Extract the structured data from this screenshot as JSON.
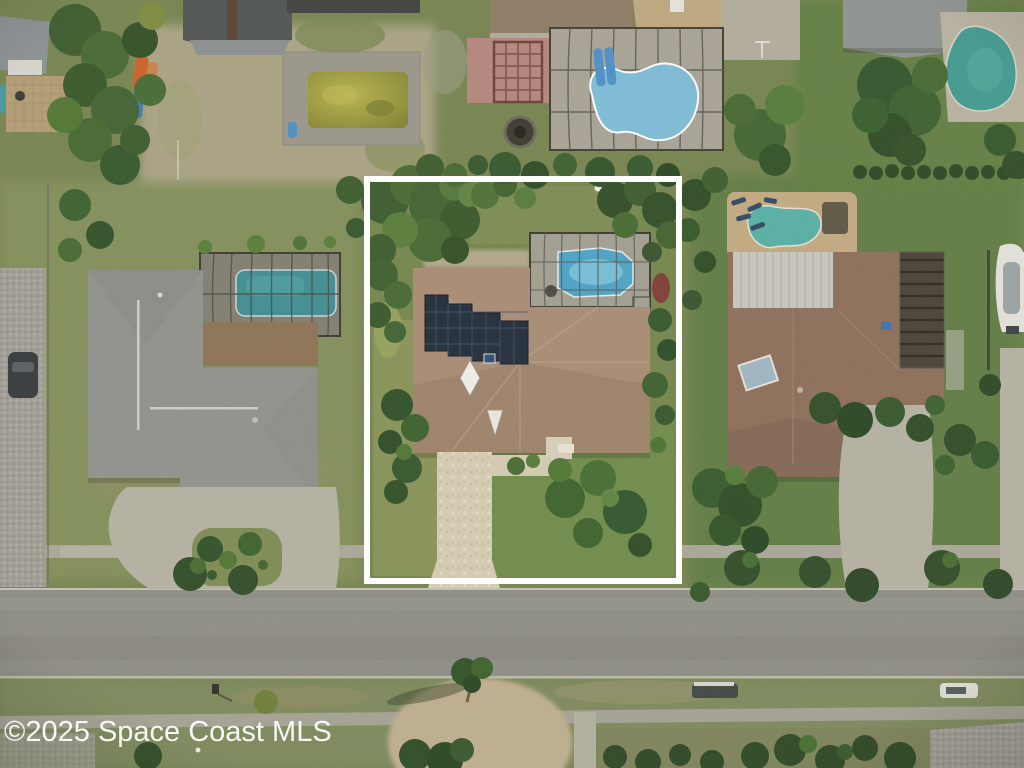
{
  "watermark": {
    "text": "©2025 Space Coast MLS",
    "color": "#ffffff"
  },
  "property_outline": {
    "shape": "rectangle",
    "color": "#ffffff"
  },
  "palette": {
    "grass": "#75834e",
    "grass_bright": "#5c7a40",
    "grass_pale": "#8a9459",
    "road": "#8e8d85",
    "sidewalk": "#aaa79a",
    "paver_driveway": "#d8cdb4",
    "concrete": "#b5b2a4",
    "sand": "#ada487",
    "center_roof": "#a98b74",
    "left_roof": "#90918c",
    "right_roof": "#8c6d58",
    "tan_roof": "#bfa87f",
    "dark_roof": "#4d5152",
    "solar_panel": "#1f2a38",
    "pool_blue": "#4aa3c8",
    "pool_aqua": "#7dbcd8",
    "pool_teal": "#3e8d92",
    "pool_sea": "#55b0a6",
    "pool_green_murky": "#a8a33c",
    "tree_dark": "#2f4a26",
    "tree_mid": "#4a6b33",
    "outline_white": "#ffffff"
  },
  "scene": {
    "view": "overhead aerial photo of residential neighborhood",
    "objects": [
      "white rectangular property boundary outline",
      "center house with rooftop solar panel array",
      "screened swimming pool enclosure",
      "paver driveway to street",
      "left neighbor house with screened pool and gravel side yard",
      "top neighbor houses with pools and patios",
      "right neighbor house with pool deck and parked boat",
      "street with sidewalks and palm trees",
      "murky green abandoned pool at top left"
    ]
  }
}
